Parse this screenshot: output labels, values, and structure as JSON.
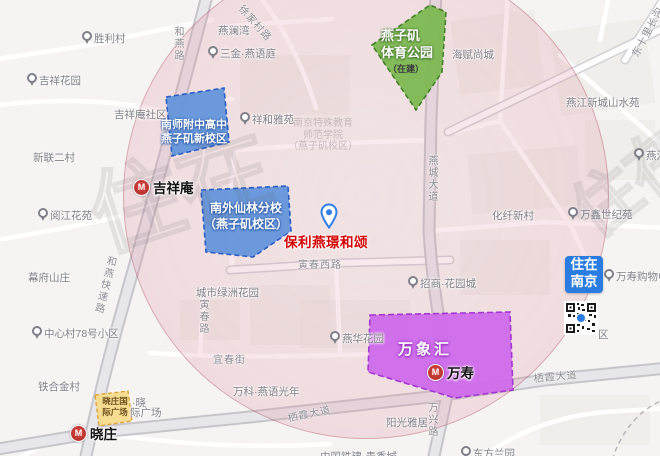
{
  "map": {
    "title": "保利燕璟和颂周边配套地图",
    "colors": {
      "map_bg": "#f5f4f2",
      "property_red": "#d50000",
      "badge_blue": "#2b7ce0",
      "school_blue": "#6092db",
      "park_green": "#7cb752",
      "mall_purple": "#cd69eb",
      "plaza_yellow": "#f7db8c",
      "circle_pink": "rgba(206,100,125,0.3)",
      "metro_red": "#b02a28"
    },
    "property": {
      "name": "保利燕璟和颂"
    },
    "badge": {
      "lines": [
        "住在",
        "南京"
      ]
    },
    "metro_icon_glyph": "M",
    "areas": [
      {
        "name": "南师附中高中燕子矶新校区",
        "label_lines": [
          "南师附中高中",
          "燕子矶新校区"
        ],
        "color": "#6092db"
      },
      {
        "name": "南外仙林分校（燕子矶校区）",
        "label_lines": [
          "南外仙林分校",
          "（燕子矶校区）"
        ],
        "color": "#6092db"
      },
      {
        "name": "燕子矶体育公园",
        "label_lines": [
          "燕子矶",
          "体育公园"
        ],
        "status": "（在建）",
        "color": "#7cb752"
      },
      {
        "name": "万象汇",
        "label_lines": [
          "万象汇"
        ],
        "color": "#cd69eb"
      },
      {
        "name": "晓庄国际广场",
        "label_lines": [
          "晓庄国",
          "际广场"
        ],
        "color": "#f7db8c"
      }
    ],
    "stations": [
      {
        "name": "吉祥庵",
        "x": 133,
        "y": 177
      },
      {
        "name": "晓庄",
        "x": 70,
        "y": 423
      },
      {
        "name": "万寿",
        "x": 427,
        "y": 362
      }
    ],
    "faded_label": {
      "lines": [
        "南京特殊教育",
        "师范学院",
        "（燕子矶校区）"
      ]
    },
    "poi": [
      {
        "text": "胜利村",
        "x": 82,
        "y": 31,
        "pin": true
      },
      {
        "text": "吉祥花园",
        "x": 27,
        "y": 73,
        "pin": true
      },
      {
        "text": "吉祥庵社区",
        "x": 114,
        "y": 107,
        "pin": false
      },
      {
        "text": "新联二村",
        "x": 33,
        "y": 150,
        "pin": false
      },
      {
        "text": "阅江花苑",
        "x": 38,
        "y": 208,
        "pin": true
      },
      {
        "text": "燕澜湾",
        "x": 218,
        "y": 23,
        "pin": false
      },
      {
        "text": "三金·燕语庭",
        "x": 208,
        "y": 46,
        "pin": true
      },
      {
        "text": "祥和雅苑",
        "x": 240,
        "y": 112,
        "pin": true
      },
      {
        "text": "海赋尚城",
        "x": 452,
        "y": 47,
        "pin": false
      },
      {
        "text": "燕江新城山水苑",
        "x": 566,
        "y": 95,
        "pin": false
      },
      {
        "text": "燕江",
        "x": 634,
        "y": 148,
        "pin": true
      },
      {
        "text": "万鑫世纪苑",
        "x": 568,
        "y": 207,
        "pin": true
      },
      {
        "text": "化纤新村",
        "x": 492,
        "y": 208,
        "pin": false
      },
      {
        "text": "幕府山庄",
        "x": 28,
        "y": 270,
        "pin": false
      },
      {
        "text": "中心村78号小区",
        "x": 32,
        "y": 326,
        "pin": true
      },
      {
        "text": "铁合金村",
        "x": 38,
        "y": 379,
        "pin": false
      },
      {
        "text": "城市绿洲花园",
        "x": 196,
        "y": 285,
        "pin": false
      },
      {
        "text": "万科·燕语光年",
        "x": 233,
        "y": 384,
        "pin": false
      },
      {
        "text": "阳光雅居",
        "x": 386,
        "y": 415,
        "pin": false
      },
      {
        "text": "东方兰园",
        "x": 461,
        "y": 446,
        "pin": true
      },
      {
        "text": "招商·花园城",
        "x": 408,
        "y": 276,
        "pin": true
      },
      {
        "text": "燕华花园",
        "x": 330,
        "y": 331,
        "pin": true
      },
      {
        "text": "万寿购物中心",
        "x": 604,
        "y": 269,
        "pin": true
      },
      {
        "text": "区",
        "x": 598,
        "y": 327,
        "pin": false
      },
      {
        "text": "中国铁建·青秀城",
        "x": 320,
        "y": 449,
        "pin": false
      },
      {
        "text": "·晓",
        "x": 132,
        "y": 395,
        "pin": false
      },
      {
        "text": "际广场",
        "x": 130,
        "y": 405,
        "pin": false
      }
    ],
    "road_labels": [
      {
        "text": "和燕路",
        "x": 170,
        "y": 26,
        "vertical": true,
        "rot": 0
      },
      {
        "text": "和燕快速路",
        "x": 104,
        "y": 254,
        "vertical": true,
        "rot": 14
      },
      {
        "text": "燕城大道",
        "x": 424,
        "y": 155,
        "vertical": true,
        "rot": 0
      },
      {
        "text": "万兴路",
        "x": 424,
        "y": 402,
        "vertical": true,
        "rot": 0
      },
      {
        "text": "寅春路",
        "x": 195,
        "y": 299,
        "vertical": true,
        "rot": 0
      },
      {
        "text": "寅春西路",
        "x": 298,
        "y": 256,
        "vertical": false,
        "rot": 0
      },
      {
        "text": "宜春街",
        "x": 213,
        "y": 351,
        "vertical": false,
        "rot": 0
      },
      {
        "text": "栖霞大道",
        "x": 286,
        "y": 410,
        "vertical": false,
        "rot": -12
      },
      {
        "text": "栖霞大道",
        "x": 533,
        "y": 370,
        "vertical": false,
        "rot": -5
      },
      {
        "text": "东十里长沟",
        "x": 627,
        "y": 52,
        "vertical": false,
        "rot": -62
      },
      {
        "text": "徐家村路",
        "x": 247,
        "y": 1,
        "vertical": false,
        "rot": 48
      }
    ],
    "watermarks": [
      {
        "text": "住在",
        "x": 70,
        "y": 150,
        "size": 92,
        "rot": -18
      },
      {
        "text": "住在",
        "x": 548,
        "y": 180,
        "size": 66,
        "rot": -38
      }
    ]
  }
}
